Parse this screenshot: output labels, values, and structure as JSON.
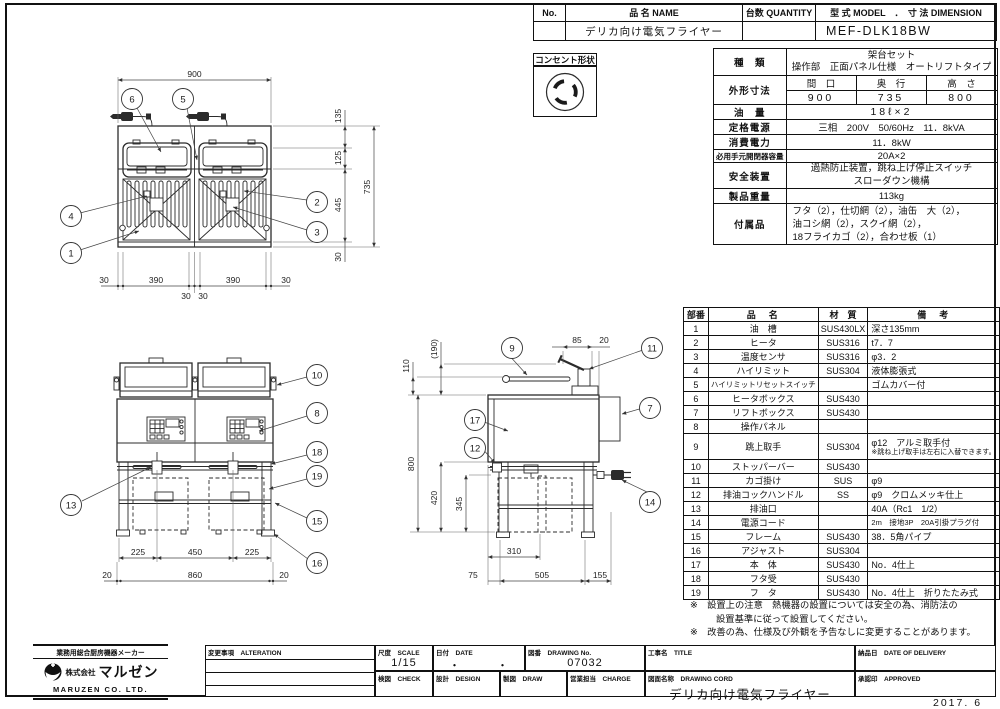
{
  "doc": {
    "date_stamp": "2017. 6"
  },
  "header_table": {
    "no_label": "No.",
    "name_label": "品 名 NAME",
    "qty_label": "台数 QUANTITY",
    "model_label": "型 式 MODEL　．　寸 法 DIMENSION",
    "name_value": "デリカ向け電気フライヤー",
    "model_value": "MEF-DLK18BW"
  },
  "outlet": {
    "label": "コンセント形状"
  },
  "spec": {
    "kind_label": "種　類",
    "kind_line1": "架台セット",
    "kind_line2": "操作部　正面パネル仕様　オートリフトタイプ",
    "dims_label": "外形寸法",
    "width_label": "間　口",
    "depth_label": "奥　行",
    "height_label": "高　さ",
    "width_value": "900",
    "depth_value": "735",
    "height_value": "800",
    "oil_label": "油　量",
    "oil_value": "18ℓ×2",
    "power_label": "定格電源",
    "power_value": "三相　200V　50/60Hz　11．8kVA",
    "consumption_label": "消費電力",
    "consumption_value": "11．8kW",
    "breaker_label": "必用手元開閉器容量",
    "breaker_value": "20A×2",
    "safety_label": "安全装置",
    "safety_line1": "過熱防止装置，跳ね上げ停止スイッチ",
    "safety_line2": "スローダウン機構",
    "weight_label": "製品重量",
    "weight_value": "113kg",
    "accessories_label": "付属品",
    "accessories_line1": "フタ（2），仕切網（2），油缶　大（2），",
    "accessories_line2": "油コシ網（2），スクイ網（2），",
    "accessories_line3": "18フライカゴ（2），合わせ板（1）"
  },
  "parts": {
    "no_header": "部番",
    "name_header": "品　名",
    "material_header": "材　質",
    "note_header": "備　考",
    "row9_note2": "※跳ね上げ取手は左右に入替できます。",
    "rows": [
      {
        "no": "1",
        "name": "油　槽",
        "material": "SUS430LX",
        "note": "深さ135mm"
      },
      {
        "no": "2",
        "name": "ヒータ",
        "material": "SUS316",
        "note": "t7．7"
      },
      {
        "no": "3",
        "name": "温度センサ",
        "material": "SUS316",
        "note": "φ3．2"
      },
      {
        "no": "4",
        "name": "ハイリミット",
        "material": "SUS304",
        "note": "液体膨張式"
      },
      {
        "no": "5",
        "name": "ハイリミットリセットスイッチ",
        "material": "",
        "note": "ゴムカバー付"
      },
      {
        "no": "6",
        "name": "ヒータボックス",
        "material": "SUS430",
        "note": ""
      },
      {
        "no": "7",
        "name": "リフトボックス",
        "material": "SUS430",
        "note": ""
      },
      {
        "no": "8",
        "name": "操作パネル",
        "material": "",
        "note": ""
      },
      {
        "no": "9",
        "name": "跳上取手",
        "material": "SUS304",
        "note": "φ12　アルミ取手付"
      },
      {
        "no": "10",
        "name": "ストッパーバー",
        "material": "SUS430",
        "note": ""
      },
      {
        "no": "11",
        "name": "カゴ掛け",
        "material": "SUS",
        "note": "φ9"
      },
      {
        "no": "12",
        "name": "排油コックハンドル",
        "material": "SS",
        "note": "φ9　クロムメッキ仕上"
      },
      {
        "no": "13",
        "name": "排油口",
        "material": "",
        "note": "40A（Rc1　1/2）"
      },
      {
        "no": "14",
        "name": "電源コード",
        "material": "",
        "note": "2m　接地3P　20A引掛プラグ付"
      },
      {
        "no": "15",
        "name": "フレーム",
        "material": "SUS430",
        "note": "38．5角パイプ"
      },
      {
        "no": "16",
        "name": "アジャスト",
        "material": "SUS304",
        "note": ""
      },
      {
        "no": "17",
        "name": "本　体",
        "material": "SUS430",
        "note": "No．4仕上"
      },
      {
        "no": "18",
        "name": "フタ受",
        "material": "SUS430",
        "note": ""
      },
      {
        "no": "19",
        "name": "フ　タ",
        "material": "SUS430",
        "note": "No．4仕上　折りたたみ式"
      }
    ]
  },
  "notes": {
    "note1_line1": "※　設置上の注意　熱機器の設置については安全の為、消防法の",
    "note1_line2": "設置基準に従って設置してください。",
    "note2": "※　改善の為、仕様及び外観を予告なしに変更することがあります。"
  },
  "titleblock": {
    "maker_tagline": "業務用総合厨房機器メーカー",
    "company_prefix": "株式会社",
    "company": "マルゼン",
    "company_en": "MARUZEN  CO. LTD.",
    "alteration_label": "変更事項　ALTERATION",
    "scale_label": "尺度　SCALE",
    "scale_value": "1/15",
    "date_label": "日付　DATE",
    "date_value": "・　　　・",
    "drawing_no_label": "図番　DRAWING No.",
    "drawing_no_value": "07032",
    "title_label": "工事名　TITLE",
    "delivery_label": "納品日　DATE OF DELIVERY",
    "check_label": "検図　CHECK",
    "design_label": "設計　DESIGN",
    "draw_label": "製図　DRAW",
    "charge_label": "営業担当　CHARGE",
    "drawing_name_label": "図面名称　DRAWING CORD",
    "drawing_name_value": "デリカ向け電気フライヤー",
    "approved_label": "承認印　APPROVED"
  },
  "drawings": {
    "plan": {
      "d900": "900",
      "d135": "135",
      "d125": "125",
      "d445": "445",
      "d30r": "30",
      "d735": "735",
      "b30a": "30",
      "b390a": "390",
      "b30b": "30",
      "b30c": "30",
      "b390b": "390",
      "b30d": "30",
      "balloon_6": "6",
      "balloon_5": "5",
      "balloon_4": "4",
      "balloon_1": "1",
      "balloon_2": "2",
      "balloon_3": "3"
    },
    "front": {
      "d225a": "225",
      "d450": "450",
      "d225b": "225",
      "d20a": "20",
      "d860": "860",
      "d20b": "20",
      "balloon_10": "10",
      "balloon_8": "8",
      "balloon_18": "18",
      "balloon_19": "19",
      "balloon_15": "15",
      "balloon_16": "16",
      "balloon_13": "13"
    },
    "side": {
      "d190": "(190)",
      "d110": "110",
      "d85": "85",
      "d20": "20",
      "d800": "800",
      "d420": "420",
      "d345": "345",
      "d310": "310",
      "d75": "75",
      "d505": "505",
      "d155": "155",
      "balloon_9": "9",
      "balloon_11": "11",
      "balloon_7": "7",
      "balloon_17": "17",
      "balloon_12": "12",
      "balloon_14": "14"
    }
  }
}
